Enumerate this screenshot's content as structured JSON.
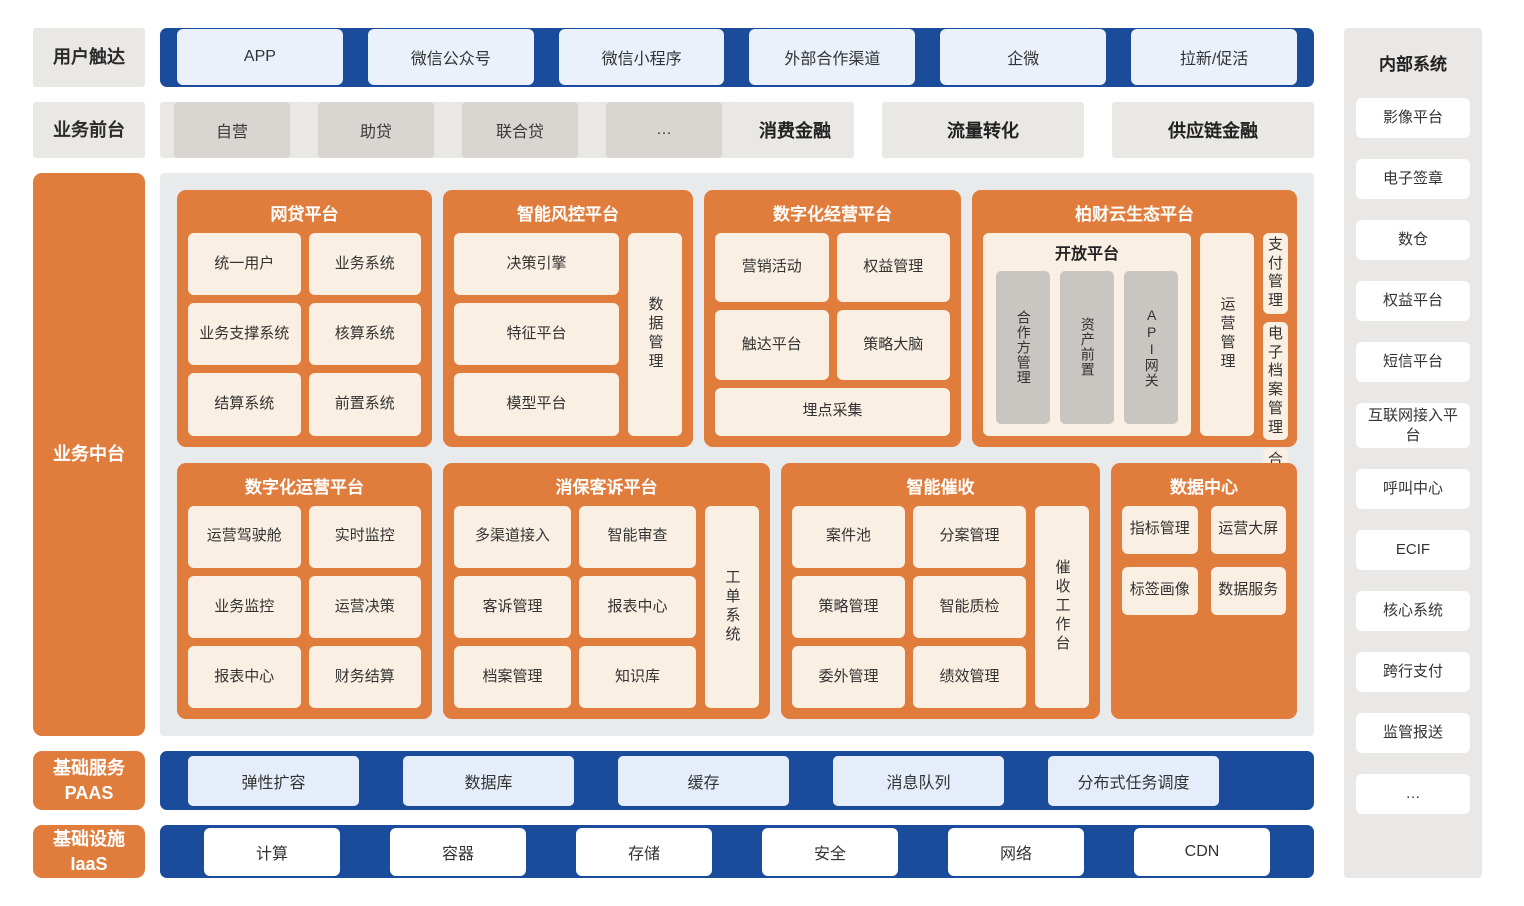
{
  "colors": {
    "blue": "#1b4c9c",
    "orange": "#e07d3c",
    "cream": "#faefe3",
    "light_blue": "#eaf1fb",
    "panel_gray": "#eae8e5",
    "middle_gray": "#e9eaec",
    "box_gray": "#d9d6d2",
    "pillar_gray": "#c9c6c2"
  },
  "rows": {
    "user_reach": {
      "label": "用户触达",
      "channels": [
        "APP",
        "微信公众号",
        "微信小程序",
        "外部合作渠道",
        "企微",
        "拉新/促活"
      ]
    },
    "front_office": {
      "label": "业务前台",
      "consumer_finance": {
        "items": [
          "自营",
          "助贷",
          "联合贷",
          "…"
        ],
        "label": "消费金融"
      },
      "blocks": [
        "流量转化",
        "供应链金融"
      ]
    },
    "middle_office": {
      "label": "业务中台"
    },
    "paas": {
      "label": "基础服务",
      "sublabel": "PAAS",
      "services": [
        "弹性扩容",
        "数据库",
        "缓存",
        "消息队列",
        "分布式任务调度"
      ]
    },
    "iaas": {
      "label": "基础设施",
      "sublabel": "IaaS",
      "services": [
        "计算",
        "容器",
        "存储",
        "安全",
        "网络",
        "CDN"
      ]
    }
  },
  "platforms": {
    "loan": {
      "title": "网贷平台",
      "cells": [
        "统一用户",
        "业务系统",
        "业务支撑系统",
        "核算系统",
        "结算系统",
        "前置系统"
      ]
    },
    "risk": {
      "title": "智能风控平台",
      "cells": [
        "决策引擎",
        "特征平台",
        "模型平台"
      ],
      "side": "数据管理"
    },
    "digital_marketing": {
      "title": "数字化经营平台",
      "cells": [
        "营销活动",
        "权益管理",
        "触达平台",
        "策略大脑"
      ],
      "wide": "埋点采集"
    },
    "ecosystem": {
      "title": "柏财云生态平台",
      "open_platform": {
        "title": "开放平台",
        "pillars": [
          "合作方管理",
          "资产前置",
          "API网关"
        ]
      },
      "side": "运营管理",
      "cells": [
        "支付管理",
        "电子档案管理",
        "合同管理"
      ]
    },
    "digital_operation": {
      "title": "数字化运营平台",
      "cells": [
        "运营驾驶舱",
        "实时监控",
        "业务监控",
        "运营决策",
        "报表中心",
        "财务结算"
      ]
    },
    "consumer_protection": {
      "title": "消保客诉平台",
      "cells": [
        "多渠道接入",
        "智能审查",
        "客诉管理",
        "报表中心",
        "档案管理",
        "知识库"
      ],
      "side": "工单系统"
    },
    "collection": {
      "title": "智能催收",
      "cells": [
        "案件池",
        "分案管理",
        "策略管理",
        "智能质检",
        "委外管理",
        "绩效管理"
      ],
      "side": "催收工作台"
    },
    "data_center": {
      "title": "数据中心",
      "cells": [
        "指标管理",
        "运营大屏",
        "标签画像",
        "数据服务"
      ]
    }
  },
  "internal_systems": {
    "title": "内部系统",
    "items": [
      "影像平台",
      "电子签章",
      "数仓",
      "权益平台",
      "短信平台",
      "互联网接入平台",
      "呼叫中心",
      "ECIF",
      "核心系统",
      "跨行支付",
      "监管报送",
      "…"
    ]
  }
}
